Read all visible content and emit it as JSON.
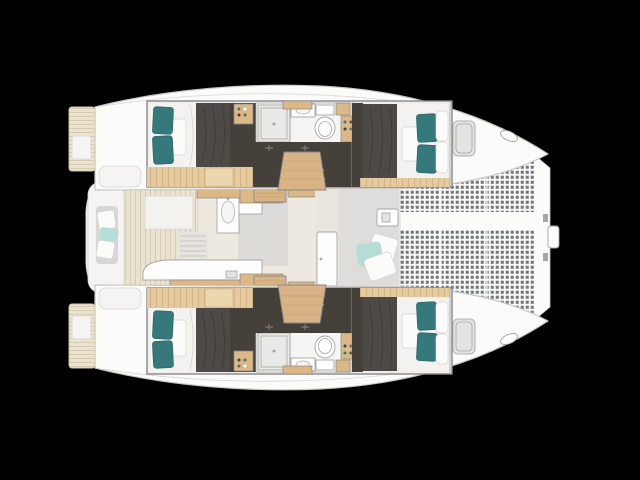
{
  "scene": {
    "type": "boat-floor-plan",
    "vessel": "catamaran",
    "view": "top-down layout plan, bow pointing right, black background",
    "visible_text": []
  },
  "layout_features": {
    "port_hull": [
      "aft-cabin-double-bed",
      "wardrobe-shelf-with-bottles",
      "bathroom-shower",
      "washbasin",
      "toilet",
      "bathroom-cabinet",
      "corridor-dark-floor",
      "companionway-steps",
      "forward-cabin-double-bed",
      "deck-hatch",
      "bow-cleat",
      "swim-platform-with-step"
    ],
    "starboard_hull": [
      "mirror-image-of-port-hull"
    ],
    "bridgedeck": [
      "aft-cockpit-bench-with-cushions",
      "cockpit-teak-floor",
      "saloon-table",
      "saloon-lounge",
      "galley-sink-unit",
      "galley-module",
      "galley-counter",
      "companionway-grate",
      "saloon-wood-cabinets",
      "saloon-steps-port",
      "saloon-steps-starboard",
      "saloon-front-door",
      "forward-cockpit-deck",
      "windlass",
      "lounge-scatter-pillows"
    ],
    "foredeck": [
      "trampoline-net-port",
      "trampoline-net-starboard",
      "center-walkway",
      "bow-crossbeam",
      "bow-fitting"
    ]
  },
  "colors": {
    "background": "#000000",
    "hull_fill": "#fbfbfa",
    "hull_stroke": "#c7c7c5",
    "bridgedeck_fill": "#f5f4f2",
    "bridgedeck_stroke": "#d8d8d6",
    "cutaway_fill": "#f0efed",
    "cutaway_border": "#87878a",
    "teak_base": "#e9e3cf",
    "teak_line": "#cfc7ab",
    "saloon_floor": "#eee9e0",
    "wood_floor": "#e4ca9e",
    "wood_floor_line": "#c8a977",
    "wood_light": "#ecd6ae",
    "wood_cabinet": "#dcb886",
    "wood_step": "#d9b386",
    "dark_sole": "#454039",
    "duvet": "#4c4946",
    "duvet_line": "#35322f",
    "mattress": "#f3f2ef",
    "pillow_teal": "#35797b",
    "pillow_teal_stroke": "#235d60",
    "pillow_white": "#fbfbf9",
    "cushion_aqua": "#b3ded8",
    "seat_gray": "#d8d7d5",
    "net_base": "#fbfbfa",
    "net_dot": "#5d6268",
    "fixture_white": "#fdfdfc",
    "fixture_stroke": "#a6a6a4",
    "shower_fill": "#e9eae8",
    "bath_floor": "#f5f5f3",
    "hatch_fill": "#e3e3e1",
    "hatch_stroke": "#b2b2b0",
    "door_wall": "#e9e6df",
    "fwd_deck": "#dedddb",
    "saloon_gray": "#dcdbd8",
    "grate_fill": "#e6e4de",
    "grate_line": "#c7c3b9",
    "soft_stroke": "#d7d5d1"
  }
}
